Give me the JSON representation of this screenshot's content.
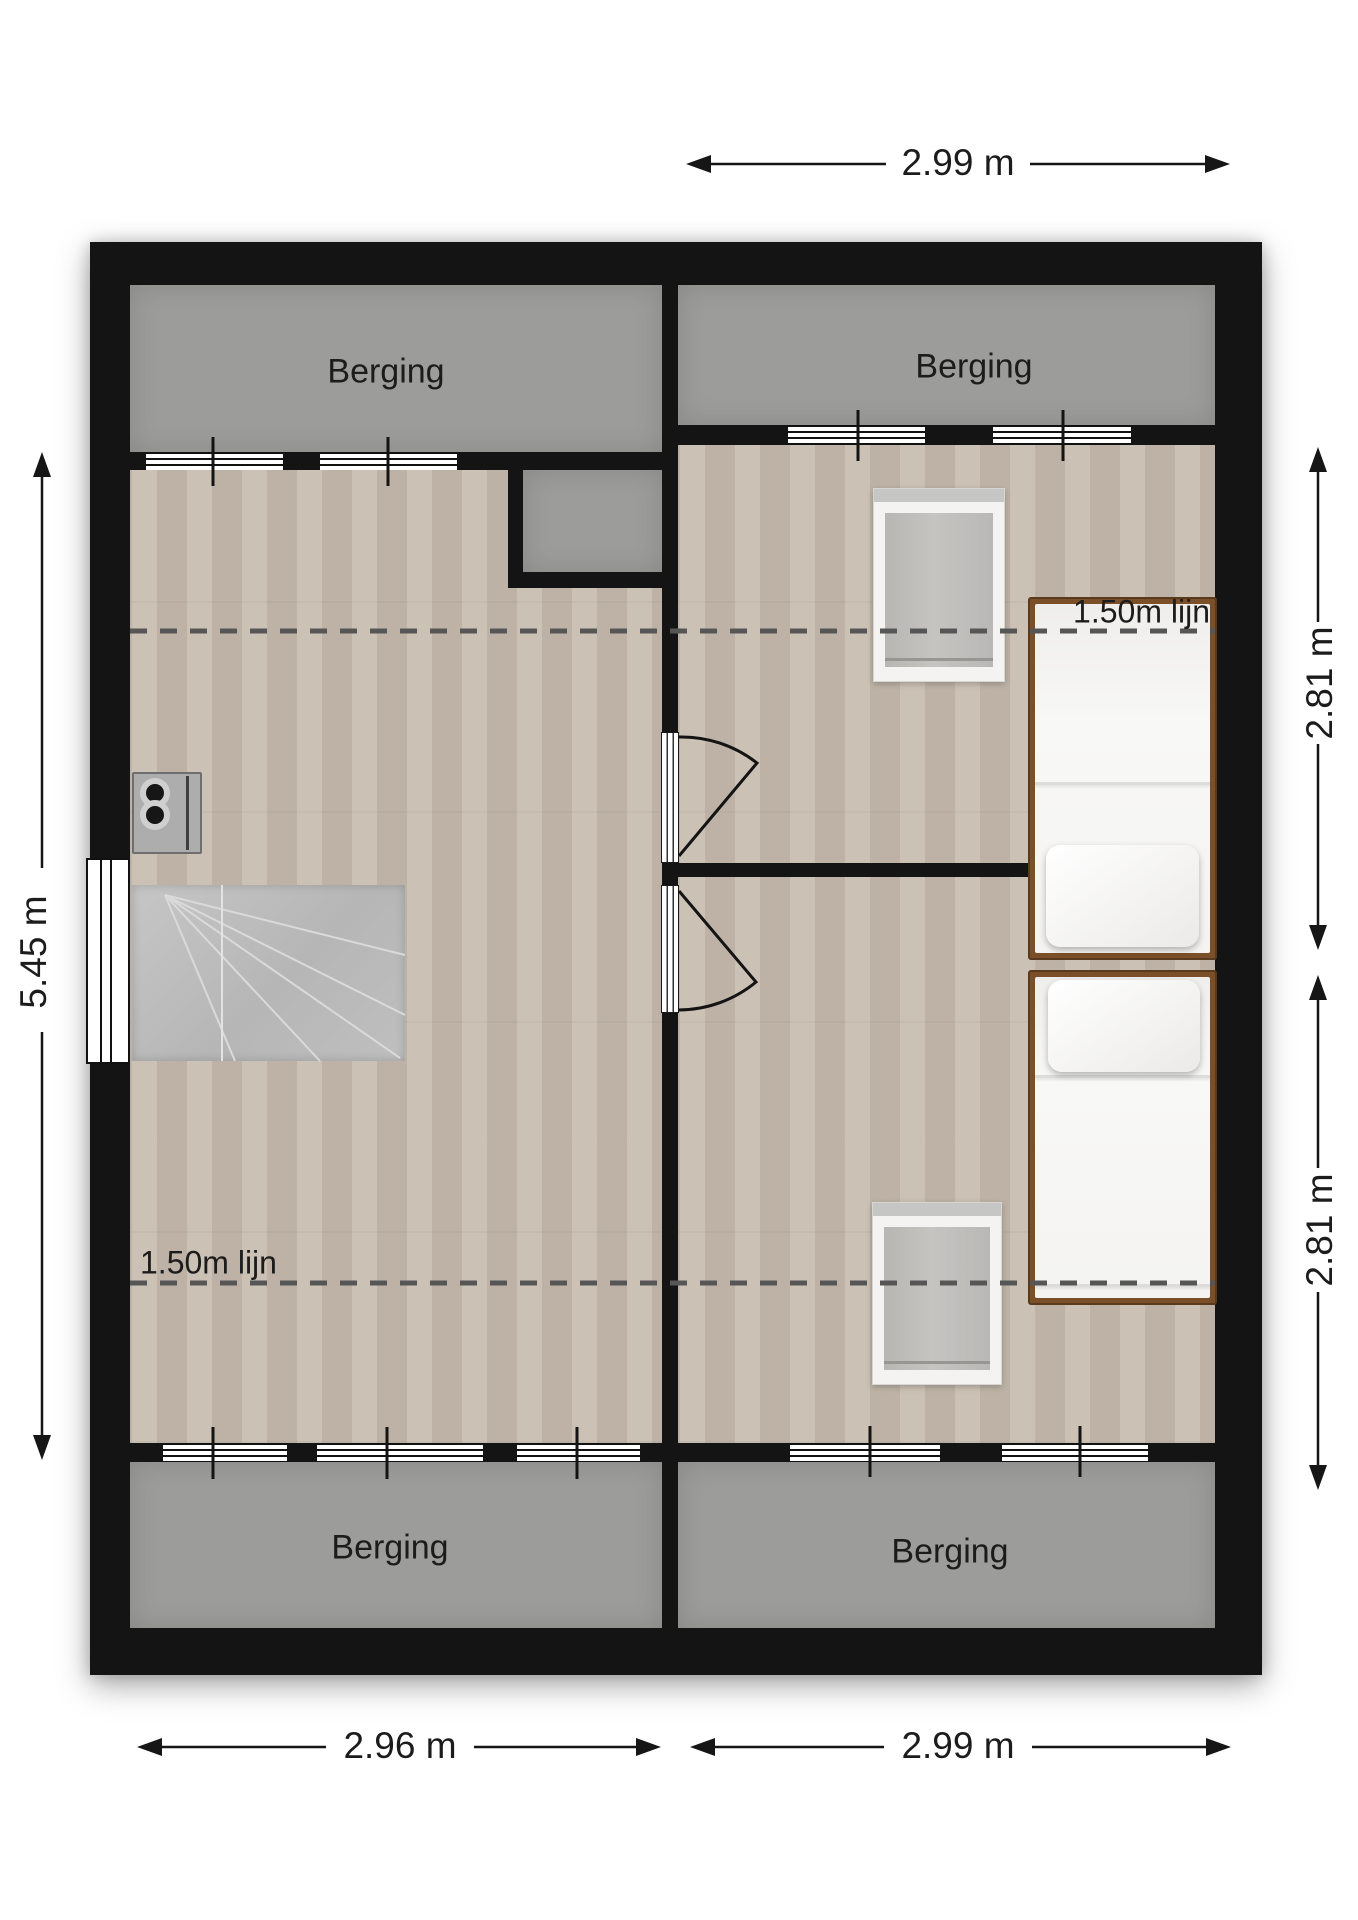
{
  "floorplan": {
    "type": "floor-plan",
    "rooms": {
      "berging_top_left": "Berging",
      "berging_top_right": "Berging",
      "berging_bottom_left": "Berging",
      "berging_bottom_right": "Berging"
    },
    "annotations": {
      "attic_line_top": "1.50m lijn",
      "attic_line_bottom": "1.50m lijn"
    },
    "dimensions": {
      "top_width": "2.99 m",
      "bottom_left_width": "2.96 m",
      "bottom_right_width": "2.99 m",
      "left_height": "5.45 m",
      "right_top_height": "2.81 m",
      "right_bottom_height": "2.81 m"
    },
    "colors": {
      "wall": "#141414",
      "storage_fill": "#9c9c9a",
      "floor_wood": "#c7bcae",
      "bed_frame": "#7b4f28",
      "dashed_line": "#565656",
      "stairs_fill": "#bdbdbd"
    }
  }
}
